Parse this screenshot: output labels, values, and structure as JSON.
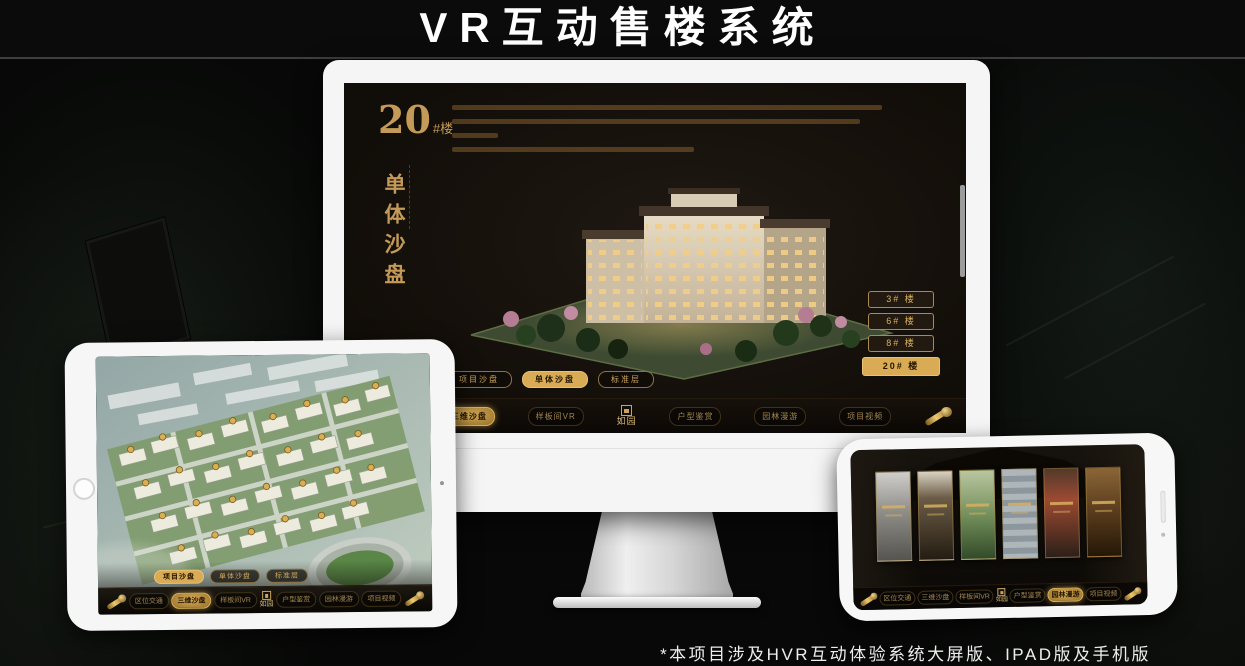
{
  "page": {
    "title": "VR互动售楼系统",
    "footnote": "*本项目涉及HVR互动体验系统大屏版、IPAD版及手机版"
  },
  "colors": {
    "gold": "#c9a254",
    "gold_bright": "#e6c36a",
    "screen_bg": "#16110c",
    "frame_white": "#f5f5f5"
  },
  "monitor": {
    "hero": {
      "number": "20",
      "suffix": "#楼",
      "subtitle": "单体沙盘"
    },
    "floor_buttons": [
      {
        "label": "3# 楼",
        "selected": false
      },
      {
        "label": "6# 楼",
        "selected": false
      },
      {
        "label": "8# 楼",
        "selected": false
      },
      {
        "label": "20# 楼",
        "selected": true
      }
    ],
    "view_tabs": [
      {
        "label": "项目沙盘",
        "selected": false
      },
      {
        "label": "单体沙盘",
        "selected": true
      },
      {
        "label": "标准层",
        "selected": false
      }
    ],
    "nav": {
      "logo": "如园",
      "active": "三维沙盘",
      "items": [
        {
          "label": "区位交通"
        },
        {
          "label": "三维沙盘"
        },
        {
          "label": "样板间VR"
        },
        {
          "label": "户型鉴赏"
        },
        {
          "label": "园林漫游"
        },
        {
          "label": "项目视频"
        }
      ]
    }
  },
  "tablet": {
    "view_tabs": [
      {
        "label": "项目沙盘",
        "selected": true
      },
      {
        "label": "单体沙盘",
        "selected": false
      },
      {
        "label": "标准层",
        "selected": false
      }
    ],
    "nav": {
      "logo": "如园",
      "active": "三维沙盘",
      "items": [
        {
          "label": "区位交通"
        },
        {
          "label": "三维沙盘"
        },
        {
          "label": "样板间VR"
        },
        {
          "label": "户型鉴赏"
        },
        {
          "label": "园林漫游"
        },
        {
          "label": "项目视频"
        }
      ]
    }
  },
  "phone": {
    "nav": {
      "logo": "如园",
      "active": "园林漫游",
      "items": [
        {
          "label": "区位交通"
        },
        {
          "label": "三维沙盘"
        },
        {
          "label": "样板间VR"
        },
        {
          "label": "户型鉴赏"
        },
        {
          "label": "园林漫游"
        },
        {
          "label": "项目视频"
        }
      ]
    }
  }
}
